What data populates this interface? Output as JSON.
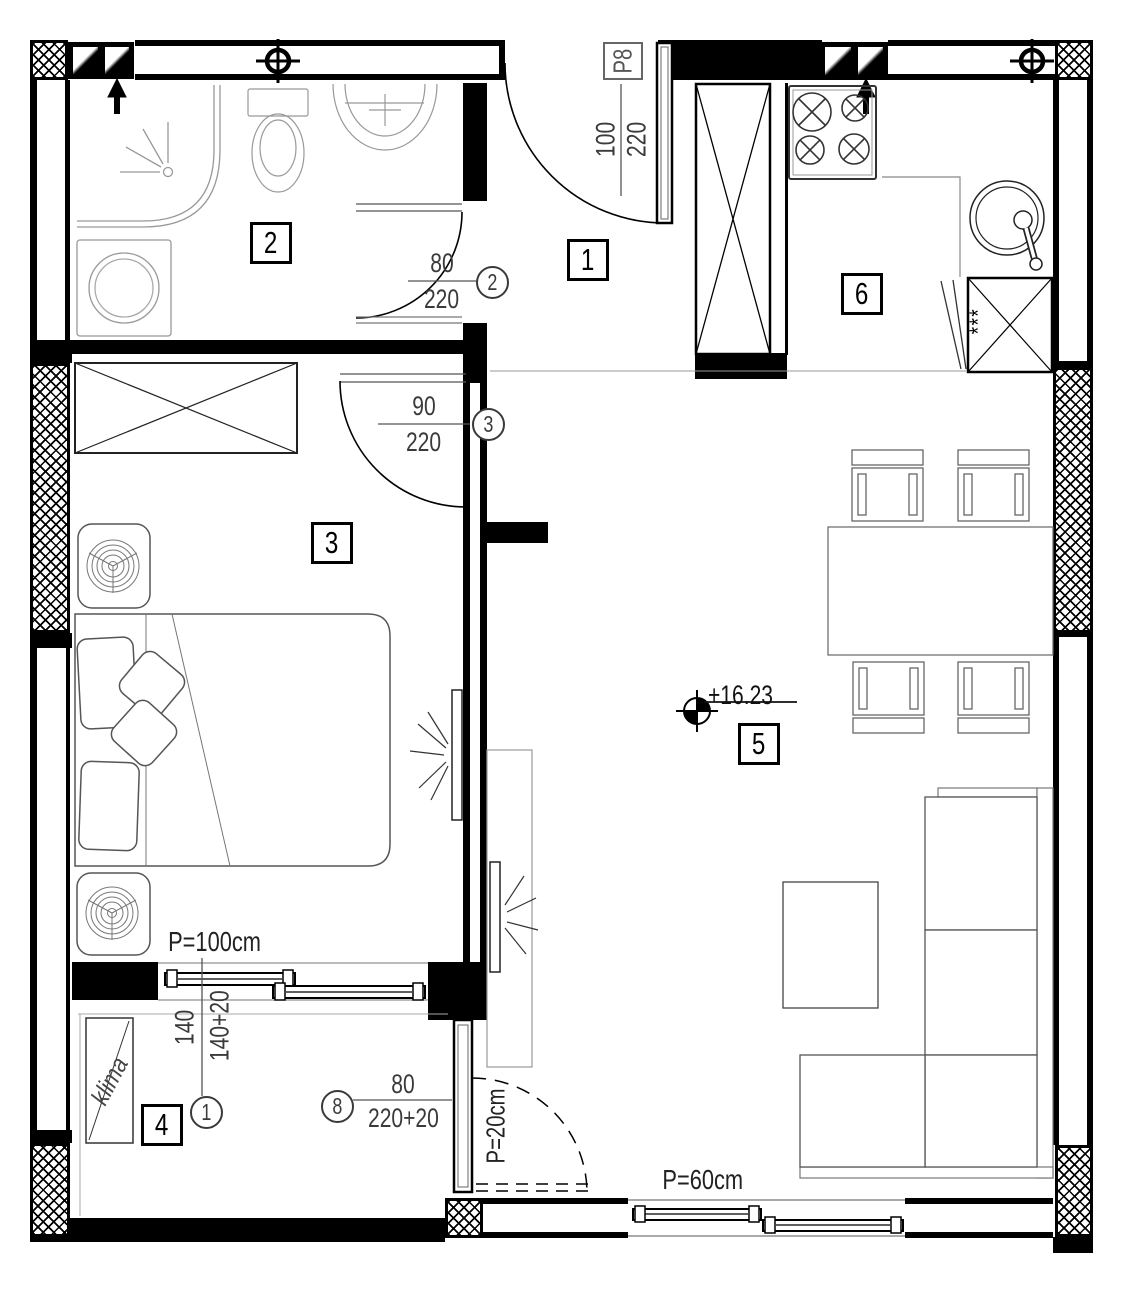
{
  "document": {
    "type": "apartment floor plan"
  },
  "rooms": [
    {
      "number": "1"
    },
    {
      "number": "2"
    },
    {
      "number": "3"
    },
    {
      "number": "4"
    },
    {
      "number": "5"
    },
    {
      "number": "6"
    }
  ],
  "doors": {
    "entrance": {
      "label": "P8",
      "dim_top": "100",
      "dim_bottom": "220"
    },
    "door2": {
      "ref": "2",
      "dim_top": "80",
      "dim_bottom": "220"
    },
    "door3": {
      "ref": "3",
      "dim_top": "90",
      "dim_bottom": "220"
    },
    "window1": {
      "ref": "1",
      "dim_top": "140",
      "dim_bottom": "140+20"
    },
    "door8": {
      "ref": "8",
      "dim_top": "80",
      "dim_bottom": "220+20"
    }
  },
  "annotations": {
    "parapet_bedroom_window": "P=100cm",
    "parapet_balcony_door": "P=20cm",
    "parapet_living_window": "P=60cm",
    "level_mark": "+16.23",
    "ac_unit": "klima",
    "freezer_marks": "***"
  }
}
